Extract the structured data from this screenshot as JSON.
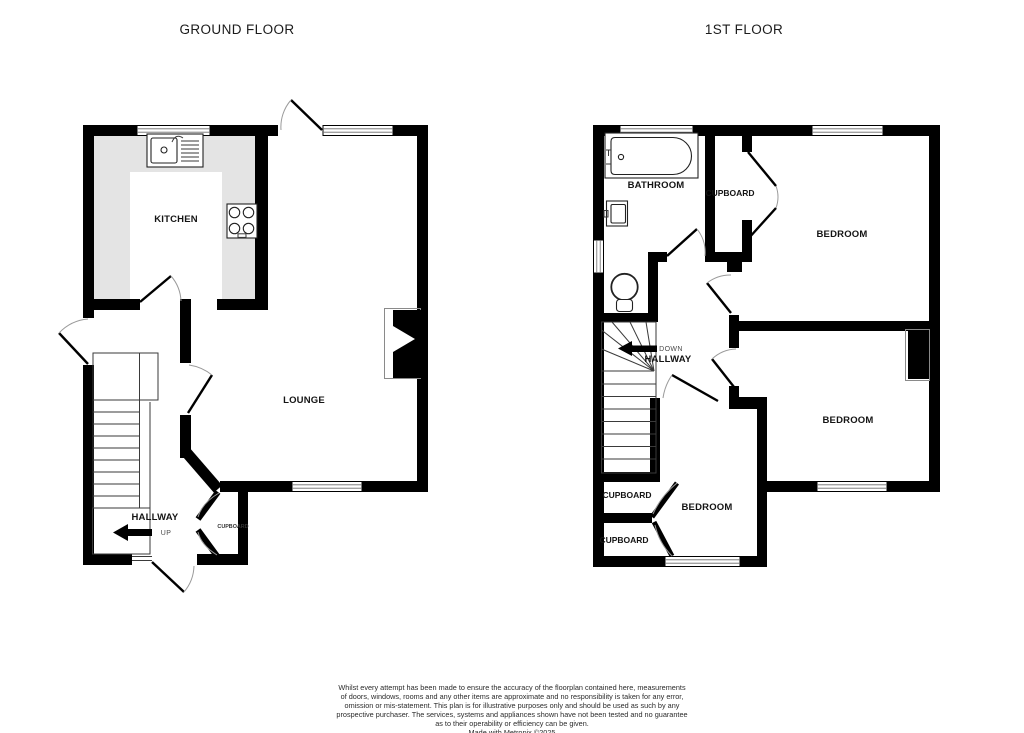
{
  "titles": {
    "ground_floor": "GROUND FLOOR",
    "first_floor": "1ST FLOOR"
  },
  "ground_floor": {
    "kitchen_label": "KITCHEN",
    "lounge_label": "LOUNGE",
    "hallway_label": "HALLWAY",
    "stairs_label": "UP",
    "cupboard_label": "CUPBOARD"
  },
  "first_floor": {
    "bathroom_label": "BATHROOM",
    "cupboard_top_label": "CUPBOARD",
    "bedroom_top_label": "BEDROOM",
    "bedroom_right_label": "BEDROOM",
    "bedroom_bottom_label": "BEDROOM",
    "cupboard_left_upper_label": "CUPBOARD",
    "cupboard_left_lower_label": "CUPBOARD",
    "hallway_label": "HALLWAY",
    "stairs_label": "DOWN"
  },
  "disclaimer": {
    "lines": [
      "Whilst every attempt has been made to ensure the accuracy of the floorplan contained here, measurements",
      "of doors, windows, rooms and any other items are approximate and no responsibility is taken for any error,",
      "omission or mis-statement. This plan is for illustrative purposes only and should be used as such by any",
      "prospective purchaser. The services, systems and appliances shown have not been tested and no guarantee",
      "as to their operability or efficiency can be given.",
      "Made with Metropix ©2025"
    ]
  },
  "colors": {
    "wall": "#000000",
    "kitchen_counter": "#e4e4e4",
    "background": "#ffffff"
  }
}
